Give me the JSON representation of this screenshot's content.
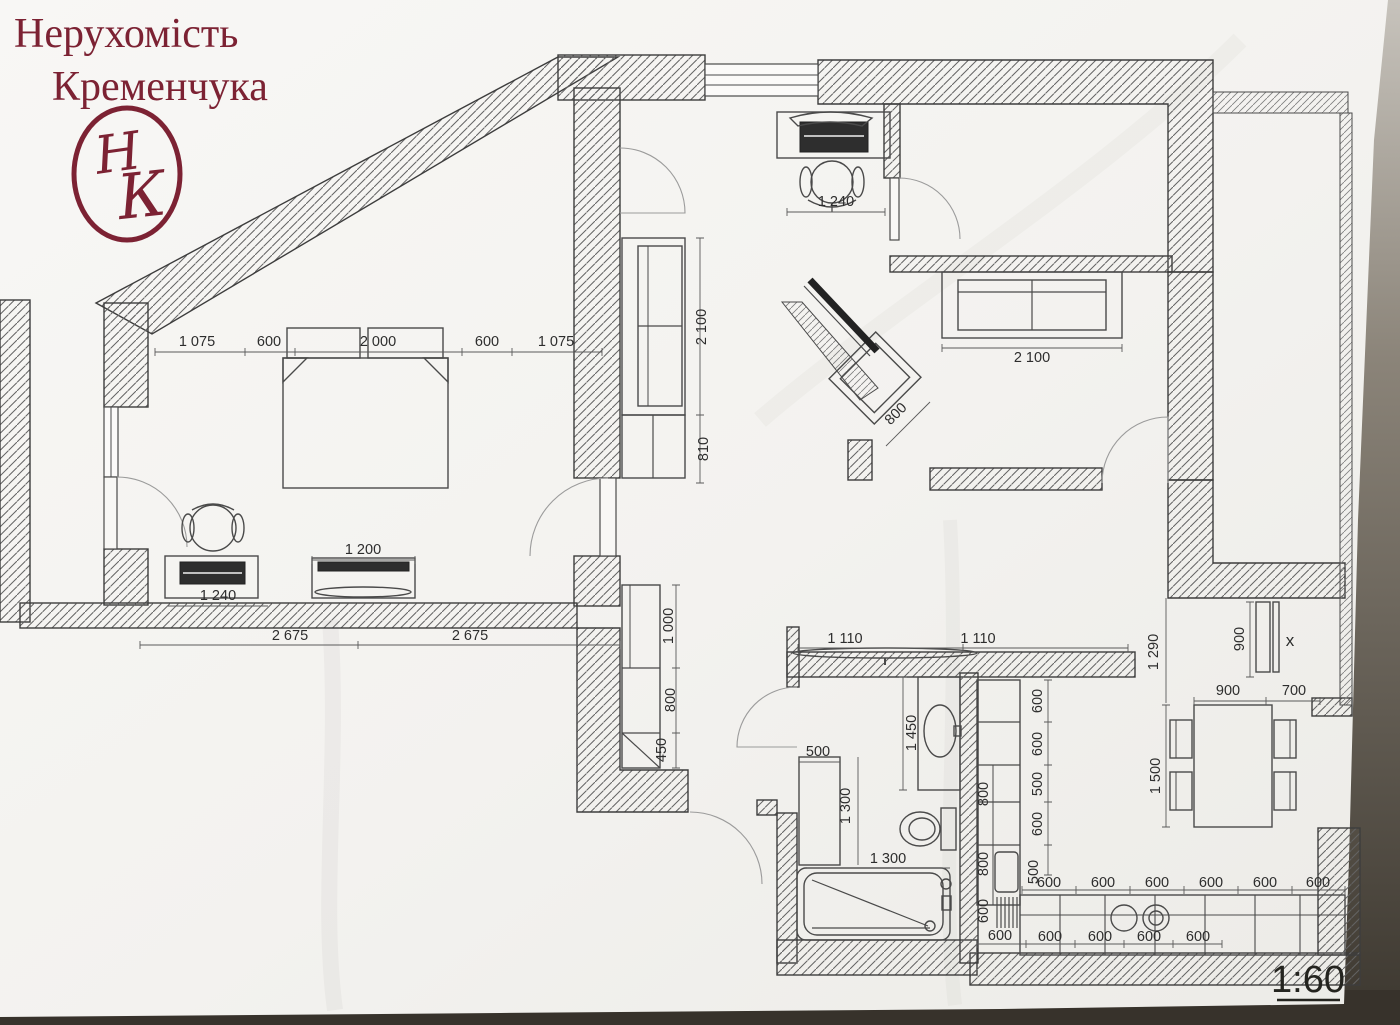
{
  "logo": {
    "line1": "Нерухомість",
    "line2": "Кременчука",
    "monogram_left": "Н",
    "monogram_right": "К",
    "color": "#7c2233"
  },
  "scale_label": "1:60",
  "colors": {
    "paper": "#f6f5f2",
    "table_dark": "#38332c",
    "ink": "#2d2d2d",
    "wall_hatch": "#636363"
  },
  "plan": {
    "dims": [
      {
        "v": "1 240"
      },
      {
        "v": "1 075"
      },
      {
        "v": "600"
      },
      {
        "v": "2 000"
      },
      {
        "v": "600"
      },
      {
        "v": "1 075"
      },
      {
        "v": "2 100"
      },
      {
        "v": "810"
      },
      {
        "v": "2 100"
      },
      {
        "v": "800"
      },
      {
        "v": "1 240"
      },
      {
        "v": "1 200"
      },
      {
        "v": "2 675"
      },
      {
        "v": "2 675"
      },
      {
        "v": "1 000"
      },
      {
        "v": "800"
      },
      {
        "v": "450"
      },
      {
        "v": "1 110"
      },
      {
        "v": "1 110"
      },
      {
        "v": "1 450"
      },
      {
        "v": "500"
      },
      {
        "v": "1 300"
      },
      {
        "v": "1 300"
      },
      {
        "v": "900"
      },
      {
        "v": "x"
      },
      {
        "v": "1 290"
      },
      {
        "v": "900"
      },
      {
        "v": "700"
      },
      {
        "v": "1 500"
      },
      {
        "v": "600"
      },
      {
        "v": "600"
      },
      {
        "v": "500"
      },
      {
        "v": "600"
      },
      {
        "v": "500"
      },
      {
        "v": "800"
      },
      {
        "v": "800"
      },
      {
        "v": "600"
      },
      {
        "v": "600"
      },
      {
        "v": "600"
      },
      {
        "v": "600"
      },
      {
        "v": "600"
      },
      {
        "v": "600"
      },
      {
        "v": "600"
      },
      {
        "v": "600"
      },
      {
        "v": "600"
      },
      {
        "v": "600"
      },
      {
        "v": "600"
      },
      {
        "v": "600"
      }
    ]
  }
}
